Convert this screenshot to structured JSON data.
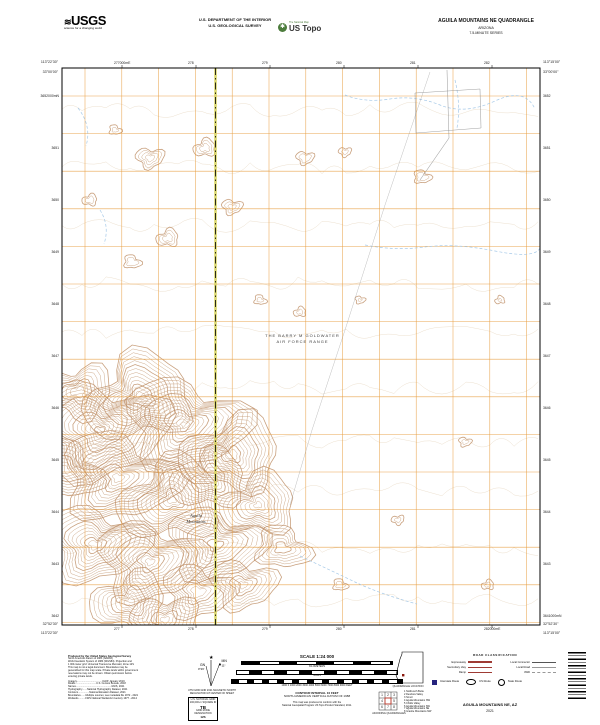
{
  "colors": {
    "grid_orange": "#e79c3c",
    "contour_brown": "#bf9168",
    "contour_faint": "#dcc6a8",
    "stream_blue": "#9cc3e6",
    "boundary_olive": "#d8d45f",
    "road_gray": "#8a8a8a",
    "legend_red": "#9f3b34",
    "interstate_blue": "#26247e",
    "ustopo_green": "#4c7c3c"
  },
  "header": {
    "usgs_logo_text": "USGS",
    "usgs_tagline": "science for a changing world",
    "dept_line1": "U.S. DEPARTMENT OF THE INTERIOR",
    "dept_line2": "U.S. GEOLOGICAL SURVEY",
    "ustopo_tag": "The National Map",
    "ustopo_name": "US Topo",
    "quad_title": "AGUILA MOUNTAINS NE QUADRANGLE",
    "quad_state": "ARIZONA",
    "quad_series": "7.5-MINUTE SERIES"
  },
  "map": {
    "label_range_line1": "THE BARRY M GOLDWATER",
    "label_range_line2": "AIR FORCE RANGE",
    "label_mtn_line1": "Aguila",
    "label_mtn_line2": "Mountains",
    "corner_tl_lon": "113°22'30\"",
    "corner_tl_lat": "33°00'00\"",
    "corner_tr_lon": "113°15'00\"",
    "corner_tr_lat": "33°00'00\"",
    "corner_bl_lon": "113°22'30\"",
    "corner_bl_lat": "32°52'30\"",
    "corner_br_lon": "113°15'00\"",
    "corner_br_lat": "32°52'30\"",
    "top_labels": [
      "277000mE",
      "278",
      "279",
      "280",
      "281",
      "282"
    ],
    "bottom_labels": [
      "277",
      "278",
      "279",
      "280",
      "281",
      "282000mE"
    ],
    "left_labels": [
      "3652000mN",
      "3651",
      "3650",
      "3649",
      "3648",
      "3647",
      "3646",
      "3645",
      "3644",
      "3643",
      "3642"
    ],
    "right_labels": [
      "3652",
      "3651",
      "3650",
      "3649",
      "3648",
      "3647",
      "3646",
      "3645",
      "3644",
      "3643",
      "3641000mN"
    ]
  },
  "footer": {
    "produced_by": [
      "Produced by the United States Geological Survey",
      "North American Datum of 1983 (NAD83)",
      "World Geodetic System of 1984 (WGS84).  Projection and",
      "1 000-meter grid: Universal Transverse Mercator, Zone 12S",
      "This map is not a legal document. Boundaries may be",
      "generalized for this map scale. Private lands within government",
      "reservations may not be shown. Obtain permission before",
      "entering private lands.",
      "Imagery.....................................NAIP, January 2019",
      "Roads..............................U.S. Census Bureau, 2018",
      "Names...................................................GNIS, 2021",
      "Hydrography.......National Hydrography Dataset, 2021",
      "Contours................National Elevation Dataset, 2021",
      "Boundaries.......Multiple sources; see metadata file 1972 - 2021",
      "Wetlands..........FWS National Wetlands Inventory 1977 - 2014"
    ],
    "decl_mn": "MN",
    "decl_gn": "GN",
    "decl_mn_val": "11°",
    "decl_gn_val": "0°26'",
    "declination_caption1": "UTM GRID AND 2021 MAGNETIC NORTH",
    "declination_caption2": "DECLINATION AT CENTER OF SHEET",
    "usng_title": "U.S. NATIONAL GRID",
    "usng_sub": "100,000-m SQUARE ID",
    "usng_square": "TB",
    "usng_zone_label": "GRID ZONE DESIGNATION",
    "usng_zone": "12S",
    "scale_title": "SCALE 1:24 000",
    "scale_row_km": "KILOMETERS",
    "scale_row_mi": "MILES",
    "scale_row_ft": "1000    0    1000    2000    3000    4000    5000    6000    7000    8000    9000    FEET",
    "contour_line1": "CONTOUR INTERVAL 10 FEET",
    "contour_line2": "NORTH AMERICAN VERTICAL DATUM OF 1988",
    "conform_line1": "This map was produced to conform with the",
    "conform_line2": "National Geospatial Program US Topo Product Standard, 2011.",
    "quad_location_label": "QUADRANGLE LOCATION",
    "adjoining_label": "ADJOINING QUADRANGLES",
    "adjoining": [
      "1 Nottbusch Butte",
      "2 Dendora Valley",
      "3 Smurr",
      "4 Aguila Mountains NW",
      "5 Childs Valley",
      "6 Aguila Mountains SW",
      "7 Aguila Mountains SE",
      "8 Granite Mountains NW"
    ],
    "road_class": {
      "title": "ROAD CLASSIFICATION",
      "left_rows": [
        "Expressway",
        "Secondary Hwy",
        "Ramp"
      ],
      "right_rows": [
        "Local Connector",
        "Local Road",
        "4WD"
      ],
      "interstate": "Interstate Route",
      "us_route": "US Route",
      "state_route": "State Route"
    },
    "map_name": "AGUILA MOUNTAINS NE, AZ",
    "map_year": "2021"
  }
}
